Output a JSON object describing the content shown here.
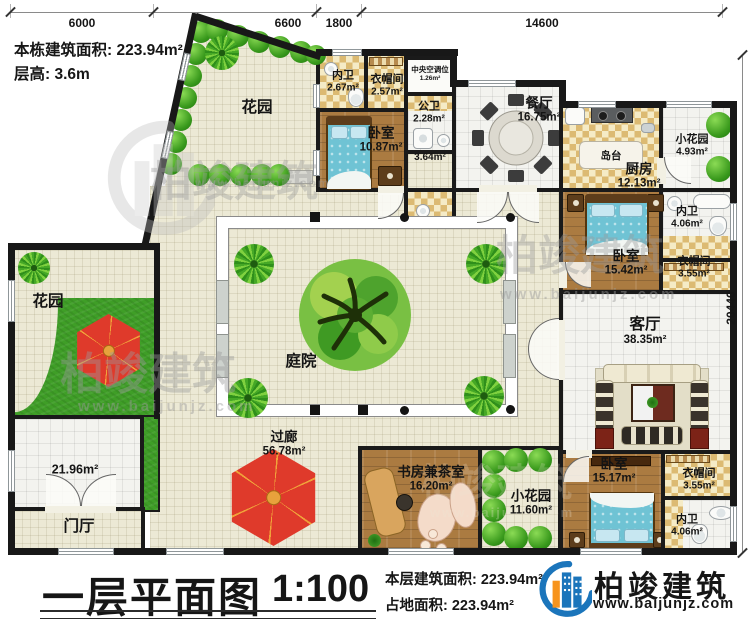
{
  "header": {
    "building_area": "本栋建筑面积: 223.94m²",
    "floor_height": "层高: 3.6m"
  },
  "dims": {
    "top": [
      "6000",
      "6600",
      "1800",
      "14600"
    ],
    "right": "20440"
  },
  "rooms": {
    "garden_top": {
      "name": "花园"
    },
    "garden_left": {
      "name": "花园"
    },
    "neiwei1": {
      "name": "内卫",
      "area": "2.67m²"
    },
    "yimaojian1": {
      "name": "衣帽间",
      "area": "2.57m²"
    },
    "hvac": {
      "name": "中央空调位",
      "area": "1.26m²"
    },
    "bedroom1": {
      "name": "卧室",
      "area": "10.87m²"
    },
    "gongwei": {
      "name": "公卫",
      "area": "2.28m²"
    },
    "hallway": {
      "area": "3.64m²"
    },
    "dining": {
      "name": "餐厅",
      "area": "16.75m²"
    },
    "island": {
      "name": "岛台"
    },
    "kitchen": {
      "name": "厨房",
      "area": "12.13m²"
    },
    "small_garden_ne": {
      "name": "小花园",
      "area": "4.93m²"
    },
    "neiwei2": {
      "name": "内卫",
      "area": "4.06m²"
    },
    "bedroom2": {
      "name": "卧室",
      "area": "15.42m²"
    },
    "yimaojian2": {
      "name": "衣帽间",
      "area": "3.55m²"
    },
    "living": {
      "name": "客厅",
      "area": "38.35m²"
    },
    "sideroom": {
      "area": "21.96m²"
    },
    "menting": {
      "name": "门厅"
    },
    "courtyard": {
      "name": "庭院"
    },
    "guolang": {
      "name": "过廊",
      "area": "56.78m²"
    },
    "study": {
      "name": "书房兼茶室",
      "area": "16.20m²"
    },
    "small_garden_s": {
      "name": "小花园",
      "area": "11.60m²"
    },
    "bedroom3": {
      "name": "卧室",
      "area": "15.17m²"
    },
    "yimaojian3": {
      "name": "衣帽间",
      "area": "3.55m²"
    },
    "neiwei3": {
      "name": "内卫",
      "area": "4.06m²"
    }
  },
  "footer": {
    "title": "一层平面图",
    "scale": "1:100",
    "floor_area": "本层建筑面积: 223.94m²",
    "land_area": "占地面积: 223.94m²"
  },
  "brand": {
    "name": "柏竣建筑",
    "url": "www.baijunjz.com"
  },
  "watermark": {
    "text": "柏竣建筑",
    "url": "www.baijunjz.com"
  },
  "colors": {
    "brand_blue": "#1b75bb",
    "brand_orange": "#f7941d",
    "wall": "#181818",
    "umbrella_red": "#df3a2b"
  }
}
